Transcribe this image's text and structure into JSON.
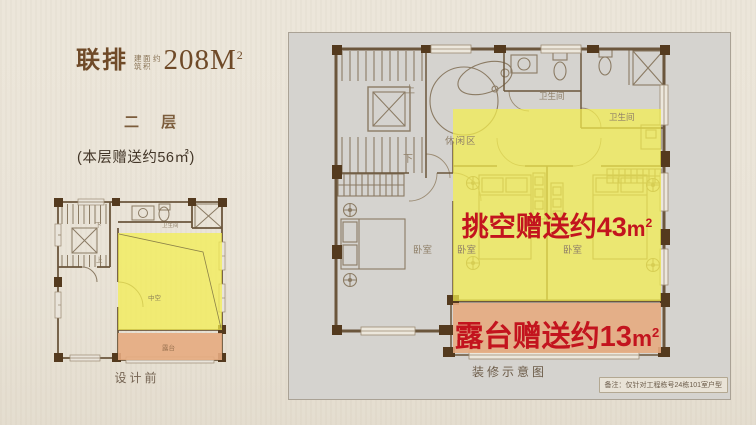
{
  "header": {
    "product_type": "联排",
    "area_note_line1": "建筑",
    "area_note_line2": "面积",
    "area_note_suffix": "约",
    "area_value": "208M",
    "area_sup": "2",
    "floor_label": "二 层",
    "floor_bonus_note": "(本层赠送约56㎡)"
  },
  "small_plan": {
    "down_label": "下",
    "up_label": "上",
    "bath_label": "卫生间",
    "void_label": "中空",
    "terrace_label": "露台",
    "caption": "设计前"
  },
  "main_plan": {
    "up_label": "上",
    "down_label": "下",
    "leisure_label": "休闲区",
    "bath_top_label": "卫生间",
    "bath_right_label": "卫生间",
    "bedroom_left_label": "卧室",
    "bedroom_mid_label": "卧室",
    "bedroom_right_label": "卧室",
    "void_bonus": {
      "text": "挑空赠送约43",
      "unit": "m",
      "sup": "2"
    },
    "terrace_bonus": {
      "text": "露台赠送约13",
      "unit": "m",
      "sup": "2"
    },
    "caption": "装修示意图",
    "disclaimer": "备注：仅针对工程栋号24栋101室户型"
  },
  "colors": {
    "highlight_yellow": "#f4ef4e",
    "terrace_orange": "#e6ab80",
    "accent_red": "#c3141e",
    "wall_brown": "#6b563c",
    "panel_gray": "#d5d3cf",
    "title_brown": "#6f4a28",
    "background_beige": "#eae4d8"
  }
}
